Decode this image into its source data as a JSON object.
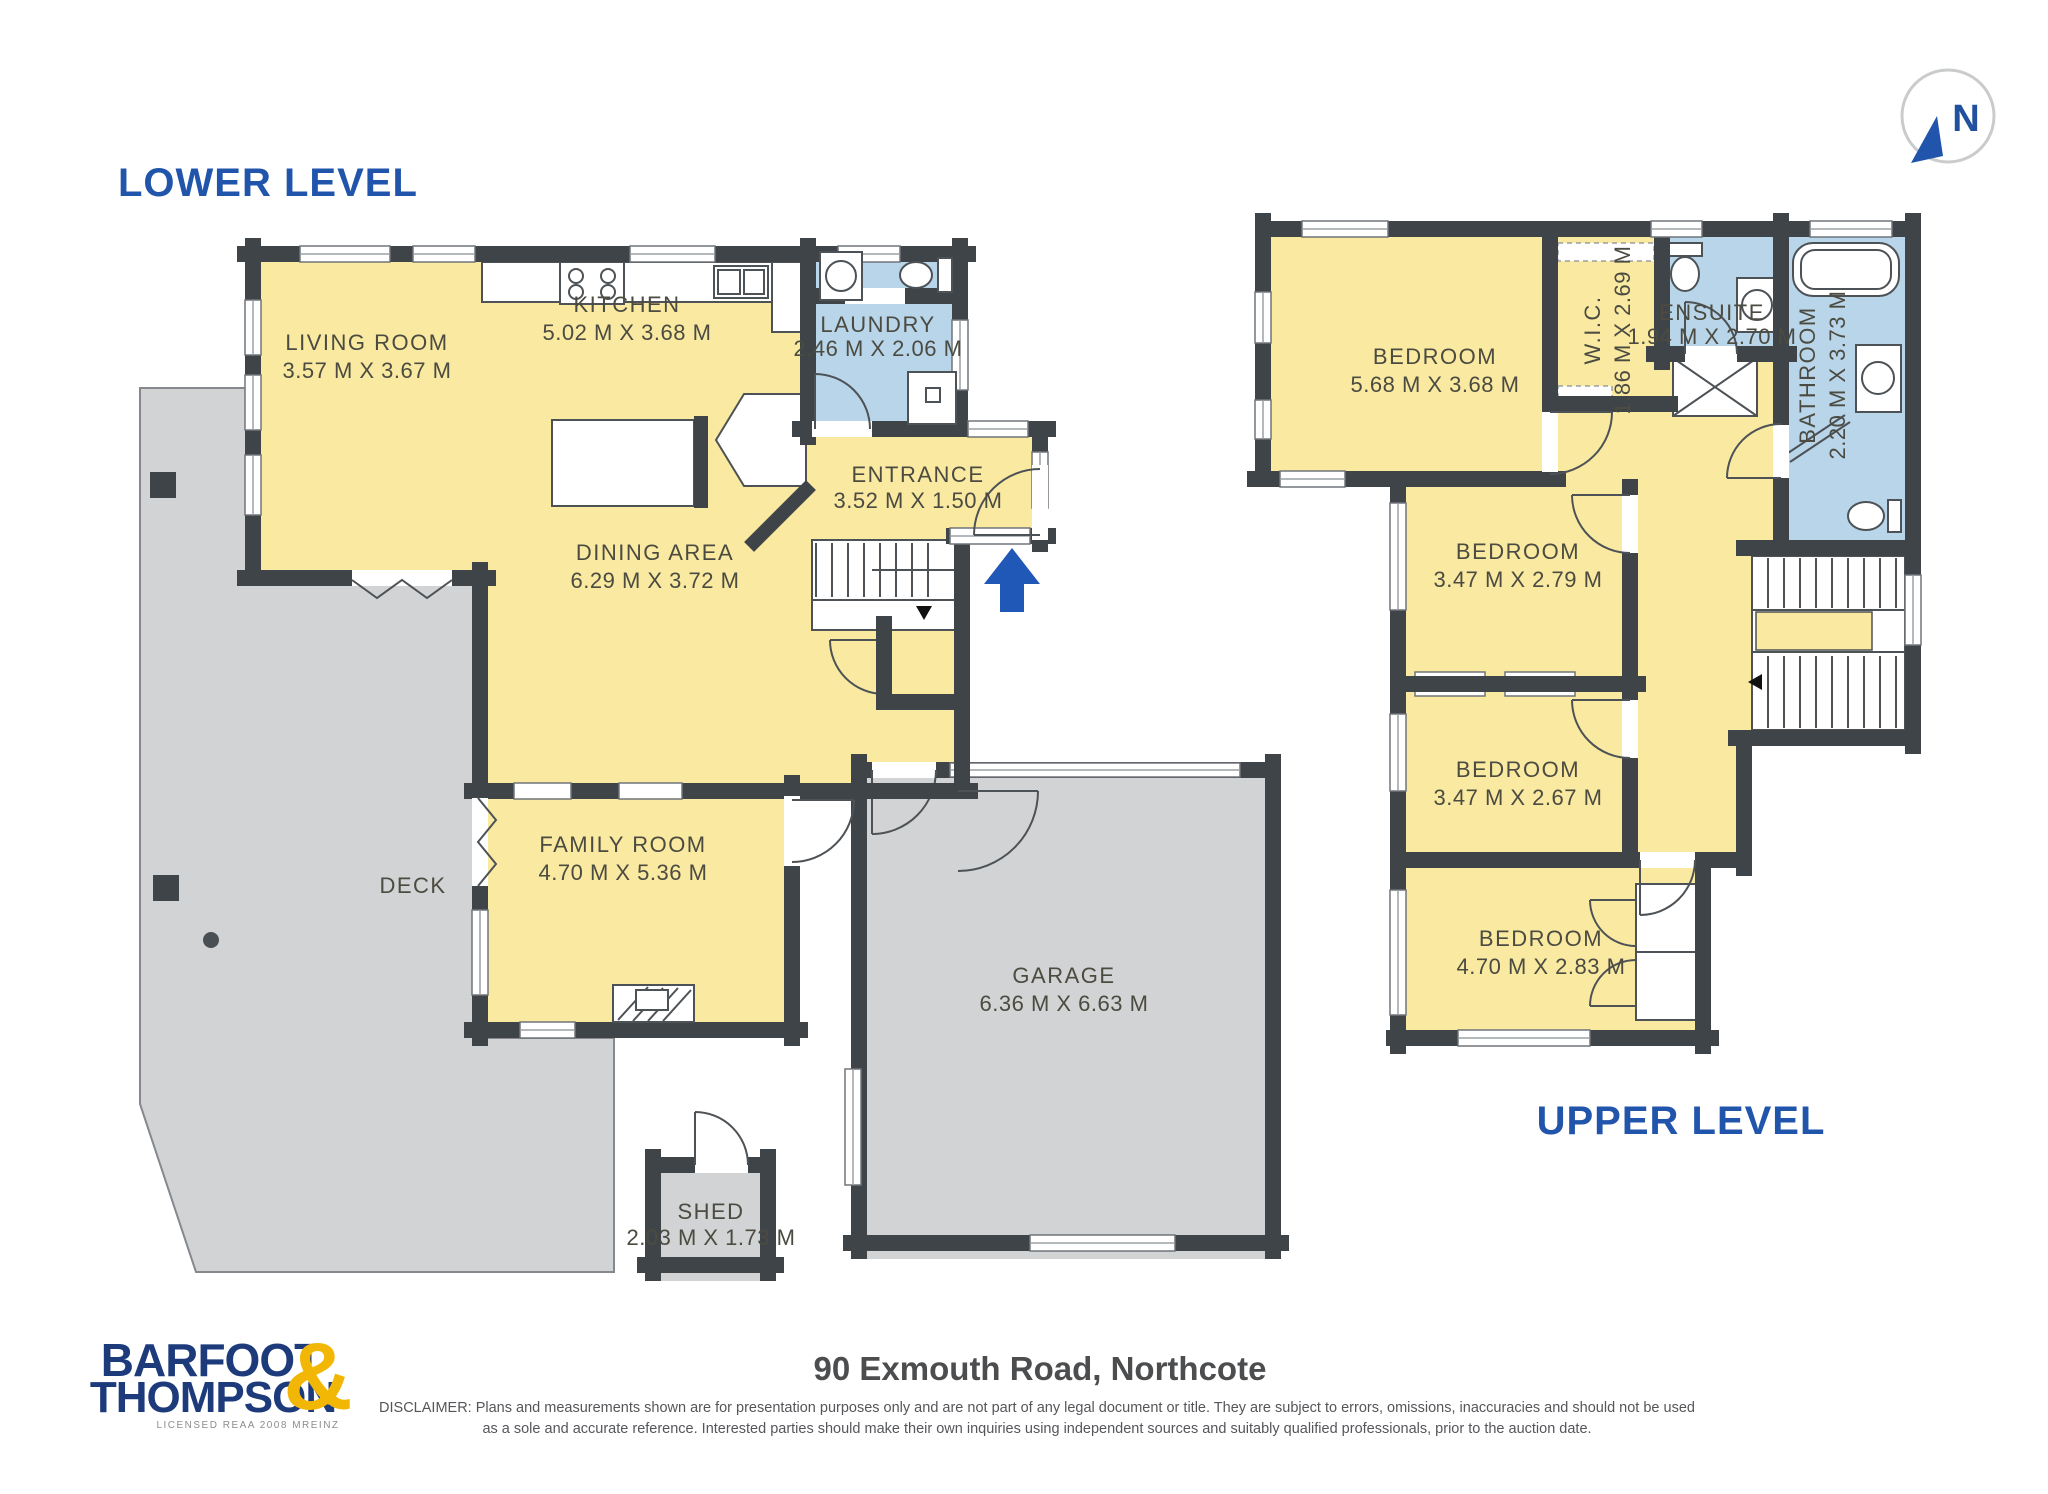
{
  "page": {
    "title_lower": "LOWER LEVEL",
    "title_upper": "UPPER LEVEL"
  },
  "north": {
    "label": "N"
  },
  "colors": {
    "floor_yellow": "#f9e9a1",
    "wet_area_blue": "#b9d5e9",
    "outdoor_gray": "#d2d3d4",
    "wall_charcoal": "#3f4448",
    "title_blue": "#2055ab",
    "logo_navy": "#1d3b7b",
    "logo_gold": "#f2b705",
    "arrow_blue": "#2058b8"
  },
  "lower": {
    "living": {
      "name": "LIVING ROOM",
      "dims": "3.57 M X 3.67 M"
    },
    "kitchen": {
      "name": "KITCHEN",
      "dims": "5.02 M X 3.68 M"
    },
    "laundry": {
      "name": "LAUNDRY",
      "dims": "2.46 M X 2.06 M"
    },
    "entrance": {
      "name": "ENTRANCE",
      "dims": "3.52 M X 1.50 M"
    },
    "dining": {
      "name": "DINING AREA",
      "dims": "6.29 M X 3.72 M"
    },
    "family": {
      "name": "FAMILY ROOM",
      "dims": "4.70 M X 5.36 M"
    },
    "deck": {
      "name": "DECK"
    },
    "garage": {
      "name": "GARAGE",
      "dims": "6.36 M X 6.63 M"
    },
    "shed": {
      "name": "SHED",
      "dims": "2.03 M X 1.73 M"
    }
  },
  "upper": {
    "bedroom1": {
      "name": "BEDROOM",
      "dims": "5.68 M X 3.68 M"
    },
    "wic": {
      "name": "W.I.C.",
      "dims": "1.86 M X 2.69 M"
    },
    "ensuite": {
      "name": "ENSUITE",
      "dims": "1.94 M X 2.70 M"
    },
    "bathroom": {
      "name": "BATHROOM",
      "dims": "2.20 M X 3.73 M"
    },
    "bedroom2": {
      "name": "BEDROOM",
      "dims": "3.47 M X 2.79 M"
    },
    "bedroom3": {
      "name": "BEDROOM",
      "dims": "3.47 M X 2.67 M"
    },
    "bedroom4": {
      "name": "BEDROOM",
      "dims": "4.70 M X 2.83 M"
    }
  },
  "footer": {
    "brand_line1": "BARFOOT",
    "brand_line2": "THOMPSON",
    "brand_amp": "&",
    "brand_sub": "LICENSED REAA 2008 MREINZ",
    "address": "90 Exmouth Road, Northcote",
    "disclaimer1": "DISCLAIMER: Plans and measurements shown are for presentation purposes only and are not part of any legal document or title. They are subject to errors, omissions, inaccuracies and should not be used",
    "disclaimer2": "as a sole and accurate reference. Interested parties should make their own inquiries using independent sources and suitably qualified professionals, prior to the auction date."
  }
}
